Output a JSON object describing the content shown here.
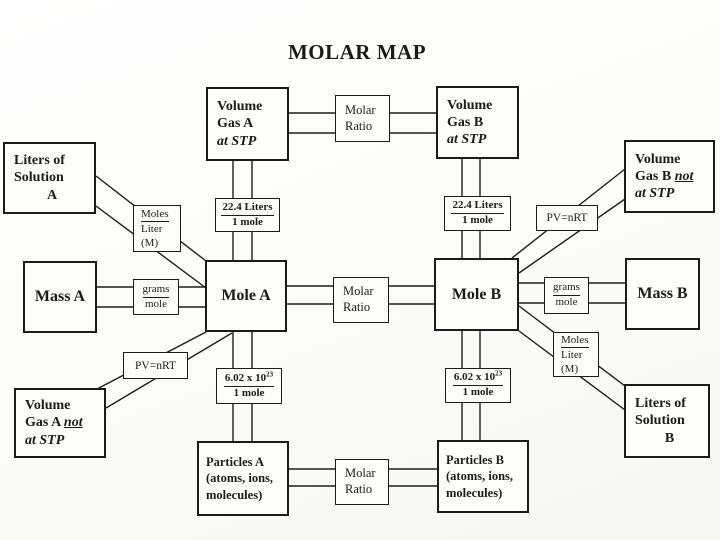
{
  "title": "MOLAR MAP",
  "colors": {
    "ink": "#1b1b1b",
    "paper": "#fdfdfb"
  },
  "nodes": {
    "volume_gas_a_stp": {
      "line1": "Volume",
      "line2": "Gas A",
      "line3": "at STP"
    },
    "volume_gas_b_stp": {
      "line1": "Volume",
      "line2": "Gas B",
      "line3": "at STP"
    },
    "volume_gas_a_not": {
      "line1": "Volume",
      "line2_prefix": "Gas A ",
      "line2_not": "not",
      "line3": "at STP"
    },
    "volume_gas_b_not": {
      "line1": "Volume",
      "line2_prefix": "Gas B ",
      "line2_not": "not",
      "line3": "at STP"
    },
    "liters_solution_a": {
      "line1": "Liters of",
      "line2": "Solution",
      "line3": "A"
    },
    "liters_solution_b": {
      "line1": "Liters of",
      "line2": "Solution",
      "line3": "B"
    },
    "mass_a": {
      "label": "Mass A"
    },
    "mass_b": {
      "label": "Mass B"
    },
    "mole_a": {
      "label": "Mole A"
    },
    "mole_b": {
      "label": "Mole B"
    },
    "particles_a": {
      "line1": "Particles A",
      "line2": "(atoms, ions,",
      "line3": "molecules)"
    },
    "particles_b": {
      "line1": "Particles B",
      "line2": "(atoms, ions,",
      "line3": "molecules)"
    }
  },
  "connectors": {
    "molar_ratio": {
      "line1": "Molar",
      "line2": "Ratio"
    },
    "liters_per_mole": {
      "num": "22.4 Liters",
      "den": "1 mole"
    },
    "avogadro": {
      "num_base": "6.02 x 10",
      "num_exp": "23",
      "den": "1 mole"
    },
    "molarity": {
      "num": "Moles",
      "den": "Liter",
      "symbol": "(M)"
    },
    "grams_per_mole": {
      "num": "grams",
      "den": "mole"
    },
    "ideal_gas": {
      "label": "PV=nRT"
    }
  }
}
